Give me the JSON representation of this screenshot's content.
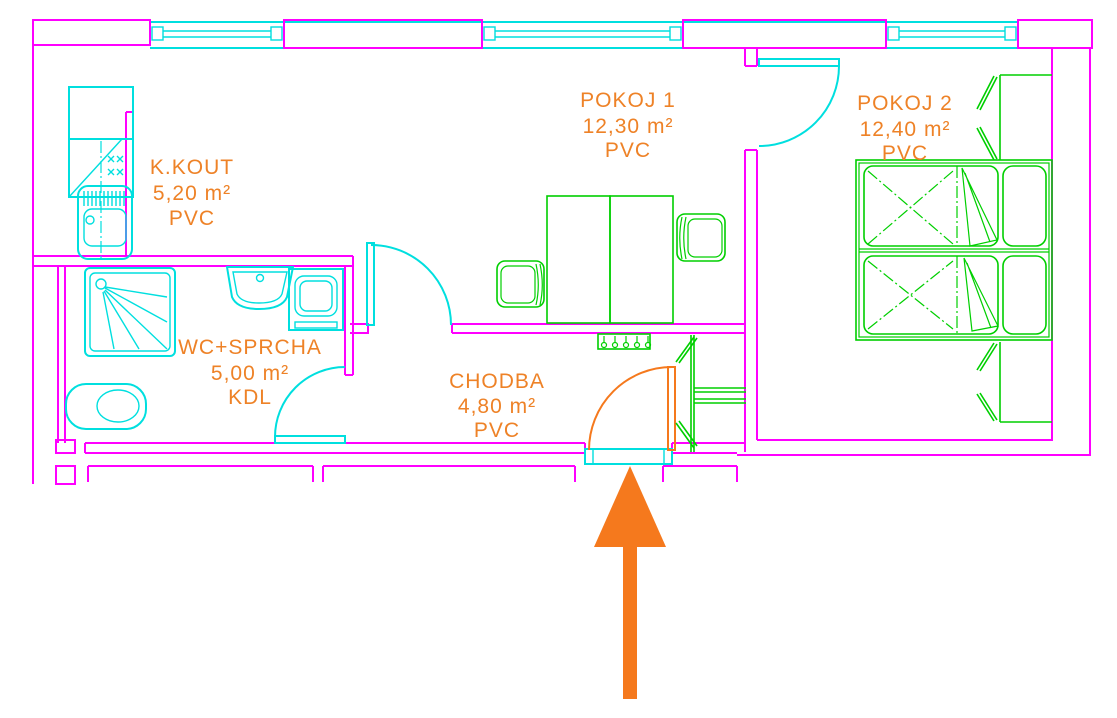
{
  "colors": {
    "wall": "#ff00ff",
    "opening": "#00dfdf",
    "furniture": "#00cf00",
    "label": "#ee8227",
    "arrow": "#f5791d",
    "background": "#ffffff"
  },
  "rooms": [
    {
      "name": "K.KOUT",
      "area": "5,20 m²",
      "floor": "PVC"
    },
    {
      "name": "POKOJ 1",
      "area": "12,30 m²",
      "floor": "PVC"
    },
    {
      "name": "POKOJ 2",
      "area": "12,40 m²",
      "floor": "PVC"
    },
    {
      "name": "WC+SPRCHA",
      "area": "5,00 m²",
      "floor": "KDL"
    },
    {
      "name": "CHODBA",
      "area": "4,80 m²",
      "floor": "PVC"
    }
  ],
  "entrance": {
    "arrow_direction": "up"
  },
  "elements": [
    "window",
    "door",
    "entrance-door",
    "kitchen-counter",
    "fridge-cabinet",
    "stove",
    "kitchen-sink",
    "shower",
    "toilet",
    "washbasin",
    "washing-machine",
    "desk",
    "chair",
    "coat-rack",
    "hall-closet",
    "wardrobe",
    "bed",
    "pillow",
    "blanket",
    "entrance-arrow"
  ]
}
